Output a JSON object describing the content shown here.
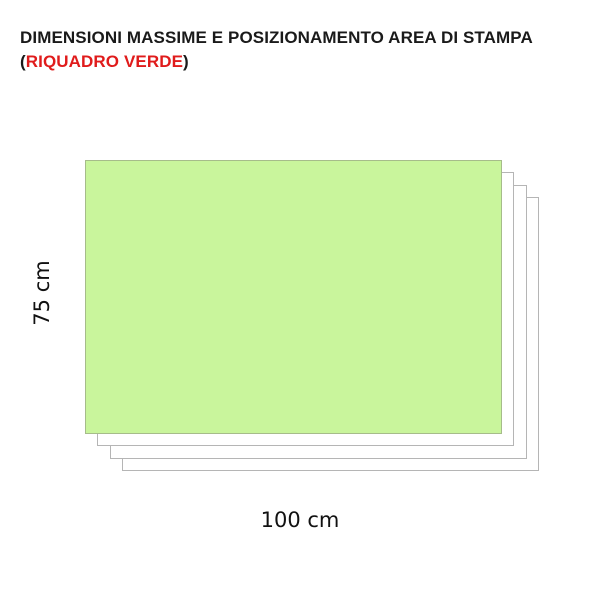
{
  "title": {
    "line1": "DIMENSIONI MASSIME E POSIZIONAMENTO AREA DI STAMPA",
    "line2_paren_open": "(",
    "line2_highlight": "RIQUADRO VERDE",
    "line2_paren_close": ")"
  },
  "diagram": {
    "print_area_label": "print-area-green-box",
    "sheet_count": 3,
    "dimensions": {
      "height_label": "75 cm",
      "width_label": "100 cm",
      "height_value_cm": 75,
      "width_value_cm": 100
    }
  },
  "colors": {
    "print_area_fill": "#c9f59c",
    "print_area_border": "#a6bc8a",
    "sheet_border": "#b5b5b5",
    "highlight_red": "#e01b1b",
    "text_black": "#1a1a1a"
  }
}
